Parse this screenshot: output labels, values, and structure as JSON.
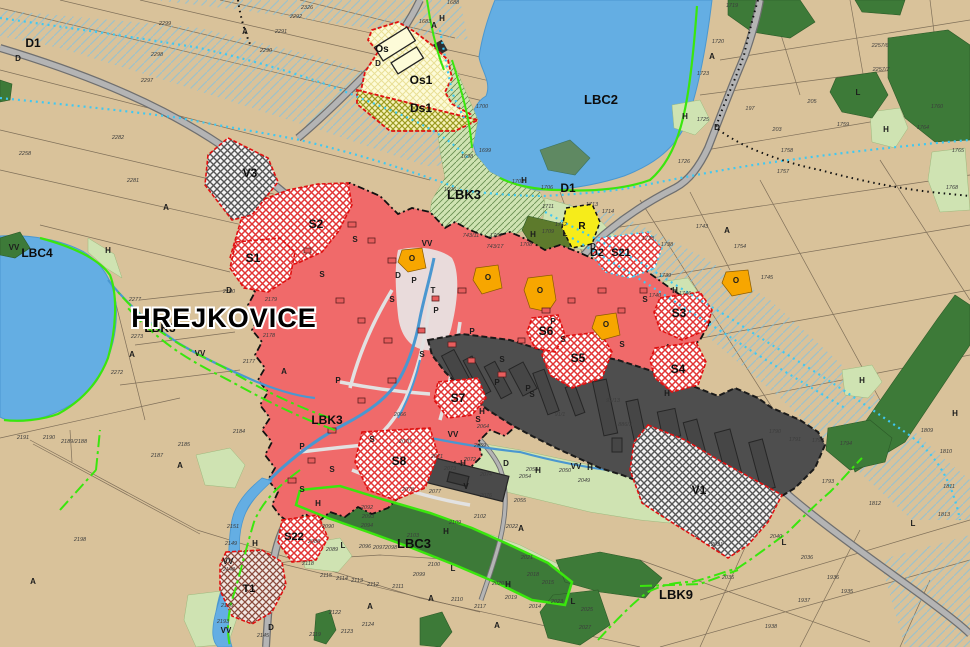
{
  "map": {
    "title": {
      "text": "HREJKOVICE",
      "x": 224,
      "y": 327,
      "size": 27
    },
    "colors": {
      "field_beige": "#d9c29a",
      "water_blue": "#64aee3",
      "built_red": "#f06a6a",
      "industrial_gray": "#4e4e4e",
      "forest_dark_green": "#3d7a38",
      "meadow_light_green": "#cfe3b2",
      "civic_orange": "#f7a600",
      "recreation_yellow": "#f6ec1a",
      "os_pale_yellow": "#fdfad2",
      "biocorridor_green": "#3ae60d",
      "melioration_cyan": "#3fc8f2",
      "road_gray": "#b4b4b4",
      "zone_border_red": "#e01010"
    },
    "zone_labels": [
      [
        33,
        47,
        "D1",
        12
      ],
      [
        601,
        104,
        "LBC2",
        13
      ],
      [
        464,
        199,
        "LBK3",
        13
      ],
      [
        568,
        192,
        "D1",
        12
      ],
      [
        597,
        256,
        "D2",
        11
      ],
      [
        621,
        256,
        "S21",
        11
      ],
      [
        253,
        262,
        "S1",
        12
      ],
      [
        316,
        228,
        "S2",
        12
      ],
      [
        679,
        317,
        "S3",
        12
      ],
      [
        678,
        373,
        "S4",
        12
      ],
      [
        578,
        362,
        "S5",
        12
      ],
      [
        546,
        335,
        "S6",
        12
      ],
      [
        458,
        402,
        "S7",
        12
      ],
      [
        399,
        465,
        "S8",
        12
      ],
      [
        294,
        540,
        "S22",
        11
      ],
      [
        249,
        592,
        "T1",
        11
      ],
      [
        699,
        494,
        "V1",
        12
      ],
      [
        250,
        177,
        "V3",
        12
      ],
      [
        382,
        52,
        "Os",
        10
      ],
      [
        421,
        84,
        "Os1",
        12
      ],
      [
        421,
        112,
        "Ds1",
        12
      ],
      [
        582,
        229,
        "R",
        10
      ],
      [
        37,
        257,
        "LBC4",
        12
      ],
      [
        414,
        548,
        "LBC3",
        13
      ],
      [
        676,
        599,
        "LBK9",
        13
      ],
      [
        160,
        332,
        "LBK3",
        12
      ],
      [
        327,
        424,
        "LBK3",
        12
      ]
    ],
    "letters": [
      [
        245,
        34,
        "A"
      ],
      [
        434,
        28,
        "A"
      ],
      [
        712,
        59,
        "A"
      ],
      [
        727,
        233,
        "A"
      ],
      [
        166,
        210,
        "A"
      ],
      [
        132,
        357,
        "A"
      ],
      [
        284,
        374,
        "A"
      ],
      [
        497,
        628,
        "A"
      ],
      [
        521,
        531,
        "A"
      ],
      [
        370,
        609,
        "A"
      ],
      [
        431,
        601,
        "A"
      ],
      [
        180,
        468,
        "A"
      ],
      [
        33,
        584,
        "A"
      ],
      [
        108,
        253,
        "H"
      ],
      [
        524,
        183,
        "H"
      ],
      [
        533,
        237,
        "H"
      ],
      [
        675,
        293,
        "H"
      ],
      [
        685,
        119,
        "H"
      ],
      [
        886,
        132,
        "H"
      ],
      [
        482,
        414,
        "H"
      ],
      [
        463,
        466,
        "H"
      ],
      [
        538,
        473,
        "H"
      ],
      [
        667,
        396,
        "H"
      ],
      [
        590,
        470,
        "H"
      ],
      [
        318,
        506,
        "H"
      ],
      [
        446,
        534,
        "H"
      ],
      [
        508,
        587,
        "H"
      ],
      [
        255,
        546,
        "H"
      ],
      [
        955,
        416,
        "H"
      ],
      [
        862,
        383,
        "H"
      ],
      [
        442,
        21,
        "H"
      ],
      [
        565,
        236,
        "L"
      ],
      [
        858,
        95,
        "L"
      ],
      [
        343,
        548,
        "L"
      ],
      [
        453,
        571,
        "L"
      ],
      [
        573,
        604,
        "L"
      ],
      [
        784,
        545,
        "L"
      ],
      [
        913,
        526,
        "L"
      ],
      [
        414,
        283,
        "P"
      ],
      [
        436,
        313,
        "P"
      ],
      [
        472,
        334,
        "P"
      ],
      [
        497,
        385,
        "P"
      ],
      [
        528,
        391,
        "P"
      ],
      [
        302,
        449,
        "P"
      ],
      [
        338,
        383,
        "P"
      ],
      [
        553,
        324,
        "P"
      ],
      [
        355,
        242,
        "S"
      ],
      [
        322,
        277,
        "S"
      ],
      [
        392,
        302,
        "S"
      ],
      [
        422,
        357,
        "S"
      ],
      [
        502,
        362,
        "S"
      ],
      [
        532,
        397,
        "S"
      ],
      [
        563,
        342,
        "S"
      ],
      [
        622,
        347,
        "S"
      ],
      [
        372,
        442,
        "S"
      ],
      [
        332,
        472,
        "S"
      ],
      [
        302,
        492,
        "S"
      ],
      [
        478,
        422,
        "S"
      ],
      [
        645,
        302,
        "S"
      ],
      [
        14,
        250,
        "VV"
      ],
      [
        200,
        356,
        "VV"
      ],
      [
        427,
        246,
        "VV"
      ],
      [
        453,
        437,
        "VV"
      ],
      [
        576,
        469,
        "VV"
      ],
      [
        228,
        564,
        "VV"
      ],
      [
        226,
        633,
        "VV"
      ],
      [
        18,
        61,
        "D"
      ],
      [
        378,
        66,
        "D"
      ],
      [
        717,
        130,
        "D"
      ],
      [
        593,
        249,
        "D"
      ],
      [
        506,
        466,
        "D"
      ],
      [
        271,
        630,
        "D"
      ],
      [
        229,
        293,
        "D"
      ],
      [
        398,
        278,
        "D"
      ],
      [
        433,
        293,
        "T"
      ],
      [
        466,
        489,
        "V"
      ],
      [
        412,
        261,
        "O"
      ],
      [
        488,
        280,
        "O"
      ],
      [
        540,
        293,
        "O"
      ],
      [
        606,
        327,
        "O"
      ],
      [
        736,
        283,
        "O"
      ]
    ],
    "parcel_numbers": [
      [
        165,
        25,
        "2299"
      ],
      [
        157,
        56,
        "2298"
      ],
      [
        147,
        82,
        "2297"
      ],
      [
        266,
        52,
        "2290"
      ],
      [
        281,
        33,
        "2291"
      ],
      [
        296,
        18,
        "2292"
      ],
      [
        307,
        9,
        "2326"
      ],
      [
        118,
        139,
        "2282"
      ],
      [
        25,
        155,
        "2258"
      ],
      [
        133,
        182,
        "2281"
      ],
      [
        453,
        4,
        "1688"
      ],
      [
        425,
        23,
        "1683"
      ],
      [
        482,
        108,
        "1700"
      ],
      [
        467,
        158,
        "1698"
      ],
      [
        485,
        152,
        "1699"
      ],
      [
        450,
        191,
        "1696"
      ],
      [
        518,
        183,
        "1703"
      ],
      [
        547,
        189,
        "1706"
      ],
      [
        732,
        7,
        "1719"
      ],
      [
        718,
        43,
        "1720"
      ],
      [
        703,
        75,
        "1723"
      ],
      [
        703,
        121,
        "1725"
      ],
      [
        684,
        163,
        "1726"
      ],
      [
        750,
        110,
        "197"
      ],
      [
        777,
        131,
        "203"
      ],
      [
        812,
        103,
        "205"
      ],
      [
        880,
        47,
        "2257/6"
      ],
      [
        881,
        71,
        "2257/7"
      ],
      [
        843,
        126,
        "1759"
      ],
      [
        787,
        152,
        "1758"
      ],
      [
        783,
        173,
        "1757"
      ],
      [
        937,
        108,
        "1760"
      ],
      [
        923,
        129,
        "1764"
      ],
      [
        958,
        152,
        "1765"
      ],
      [
        952,
        189,
        "1768"
      ],
      [
        702,
        228,
        "1743"
      ],
      [
        648,
        240,
        "1733"
      ],
      [
        667,
        246,
        "1738"
      ],
      [
        665,
        277,
        "1739"
      ],
      [
        767,
        279,
        "1745"
      ],
      [
        685,
        295,
        "1746"
      ],
      [
        655,
        297,
        "1740"
      ],
      [
        740,
        248,
        "1754"
      ],
      [
        592,
        206,
        "1713"
      ],
      [
        608,
        213,
        "1714"
      ],
      [
        561,
        226,
        "1712"
      ],
      [
        548,
        208,
        "1711"
      ],
      [
        496,
        237,
        "1707"
      ],
      [
        526,
        246,
        "1708"
      ],
      [
        548,
        233,
        "1709"
      ],
      [
        471,
        237,
        "743/11"
      ],
      [
        495,
        248,
        "743/17"
      ],
      [
        400,
        416,
        "2066"
      ],
      [
        483,
        428,
        "2064"
      ],
      [
        405,
        443,
        "2070"
      ],
      [
        480,
        447,
        "2069"
      ],
      [
        437,
        458,
        "2071"
      ],
      [
        450,
        470,
        "2073"
      ],
      [
        486,
        476,
        "2074"
      ],
      [
        470,
        461,
        "2072"
      ],
      [
        532,
        471,
        "2058"
      ],
      [
        525,
        478,
        "2054"
      ],
      [
        565,
        472,
        "2050"
      ],
      [
        584,
        482,
        "2049"
      ],
      [
        435,
        493,
        "2077"
      ],
      [
        486,
        497,
        "2076"
      ],
      [
        408,
        491,
        "2078"
      ],
      [
        520,
        502,
        "2055"
      ],
      [
        480,
        518,
        "2102"
      ],
      [
        455,
        524,
        "2109"
      ],
      [
        512,
        528,
        "2022"
      ],
      [
        413,
        537,
        "2103"
      ],
      [
        560,
        416,
        "91/1"
      ],
      [
        613,
        402,
        "91/13"
      ],
      [
        625,
        426,
        "886/3"
      ],
      [
        367,
        509,
        "2092"
      ],
      [
        368,
        518,
        "2093"
      ],
      [
        367,
        527,
        "2094"
      ],
      [
        328,
        528,
        "2090"
      ],
      [
        332,
        551,
        "2089"
      ],
      [
        314,
        543,
        "2088"
      ],
      [
        365,
        548,
        "2096"
      ],
      [
        379,
        549,
        "2097"
      ],
      [
        391,
        549,
        "2098"
      ],
      [
        434,
        566,
        "2100"
      ],
      [
        419,
        576,
        "2099"
      ],
      [
        398,
        588,
        "2111"
      ],
      [
        373,
        586,
        "2112"
      ],
      [
        357,
        582,
        "2113"
      ],
      [
        342,
        580,
        "2114"
      ],
      [
        326,
        577,
        "2115"
      ],
      [
        308,
        565,
        "2118"
      ],
      [
        335,
        614,
        "2122"
      ],
      [
        368,
        626,
        "2124"
      ],
      [
        347,
        633,
        "2123"
      ],
      [
        315,
        636,
        "2119"
      ],
      [
        527,
        559,
        "2021"
      ],
      [
        498,
        585,
        "2020"
      ],
      [
        511,
        599,
        "2019"
      ],
      [
        533,
        576,
        "2018"
      ],
      [
        548,
        584,
        "2015"
      ],
      [
        535,
        608,
        "2014"
      ],
      [
        557,
        603,
        "2023"
      ],
      [
        587,
        611,
        "2025"
      ],
      [
        585,
        629,
        "2027"
      ],
      [
        480,
        608,
        "2117"
      ],
      [
        457,
        601,
        "2110"
      ],
      [
        239,
        433,
        "2184"
      ],
      [
        184,
        446,
        "2185"
      ],
      [
        233,
        528,
        "2151"
      ],
      [
        231,
        545,
        "2149"
      ],
      [
        229,
        571,
        "2148"
      ],
      [
        227,
        607,
        "2146"
      ],
      [
        223,
        623,
        "2193"
      ],
      [
        263,
        637,
        "2145"
      ],
      [
        775,
        433,
        "1790"
      ],
      [
        795,
        441,
        "1791"
      ],
      [
        818,
        442,
        "1792"
      ],
      [
        828,
        483,
        "1793"
      ],
      [
        846,
        445,
        "1794"
      ],
      [
        776,
        538,
        "2040"
      ],
      [
        807,
        559,
        "2036"
      ],
      [
        717,
        546,
        "2031"
      ],
      [
        728,
        579,
        "2035"
      ],
      [
        833,
        579,
        "1936"
      ],
      [
        847,
        593,
        "1935"
      ],
      [
        804,
        602,
        "1937"
      ],
      [
        771,
        628,
        "1938"
      ],
      [
        875,
        505,
        "1812"
      ],
      [
        944,
        516,
        "1813"
      ],
      [
        927,
        432,
        "1809"
      ],
      [
        946,
        453,
        "1810"
      ],
      [
        949,
        488,
        "1811"
      ],
      [
        135,
        301,
        "2277"
      ],
      [
        137,
        338,
        "2273"
      ],
      [
        117,
        374,
        "2272"
      ],
      [
        269,
        337,
        "2178"
      ],
      [
        271,
        301,
        "2179"
      ],
      [
        249,
        363,
        "2177"
      ],
      [
        229,
        293,
        "2180"
      ],
      [
        23,
        439,
        "2191"
      ],
      [
        49,
        439,
        "2190"
      ],
      [
        74,
        443,
        "2189/2188"
      ],
      [
        157,
        457,
        "2187"
      ],
      [
        80,
        541,
        "2198"
      ]
    ]
  }
}
